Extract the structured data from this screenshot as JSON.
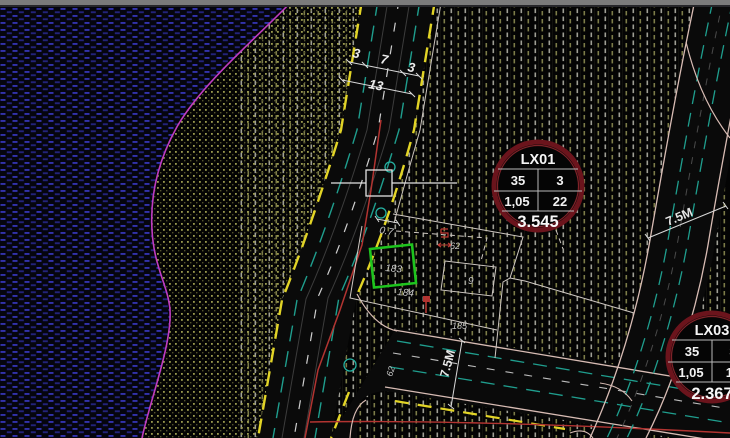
{
  "window": {
    "top_bar": ""
  },
  "dims": {
    "road_top_left": "3",
    "road_top_mid": "7",
    "road_top_right": "3",
    "road_top_total": "13",
    "offset": "0.7",
    "bottom_road_width": "7.5M",
    "right_road_width": "7.5M"
  },
  "parcels": {
    "p183": "183",
    "p184": "184",
    "p185": "185",
    "p9": "9",
    "n62": "62",
    "n62_rot": "62"
  },
  "callouts": {
    "lx01": {
      "title": "LX01",
      "r1c1": "35",
      "r1c2": "3",
      "r2c1": "1,05",
      "r2c2": "22",
      "total": "3.545"
    },
    "lx03": {
      "title": "LX03",
      "r1c1": "35",
      "r1c2": "3",
      "r2c1": "1,05",
      "r2c2": "14",
      "total": "2.367"
    }
  },
  "colors": {
    "selection_green": "#1ec41e",
    "boundary_magenta": "#c03cc0",
    "road_edge_yellow": "#e2d426",
    "lane_teal": "#1f9e8e",
    "utility_red": "#b23431",
    "callout_ring": "#6b141c",
    "callout_ring_inner": "#9e2a32",
    "hatch_blue": "#3a3ac8",
    "hatch_olive": "#9a9a4e",
    "hatch_stripe_light": "#b9b9ae",
    "hatch_stripe_olive": "#8a8a50",
    "road_fill": "#0a0a0a",
    "boundary_white": "#cfc8c2",
    "edge_pink": "#d8bcb4"
  }
}
